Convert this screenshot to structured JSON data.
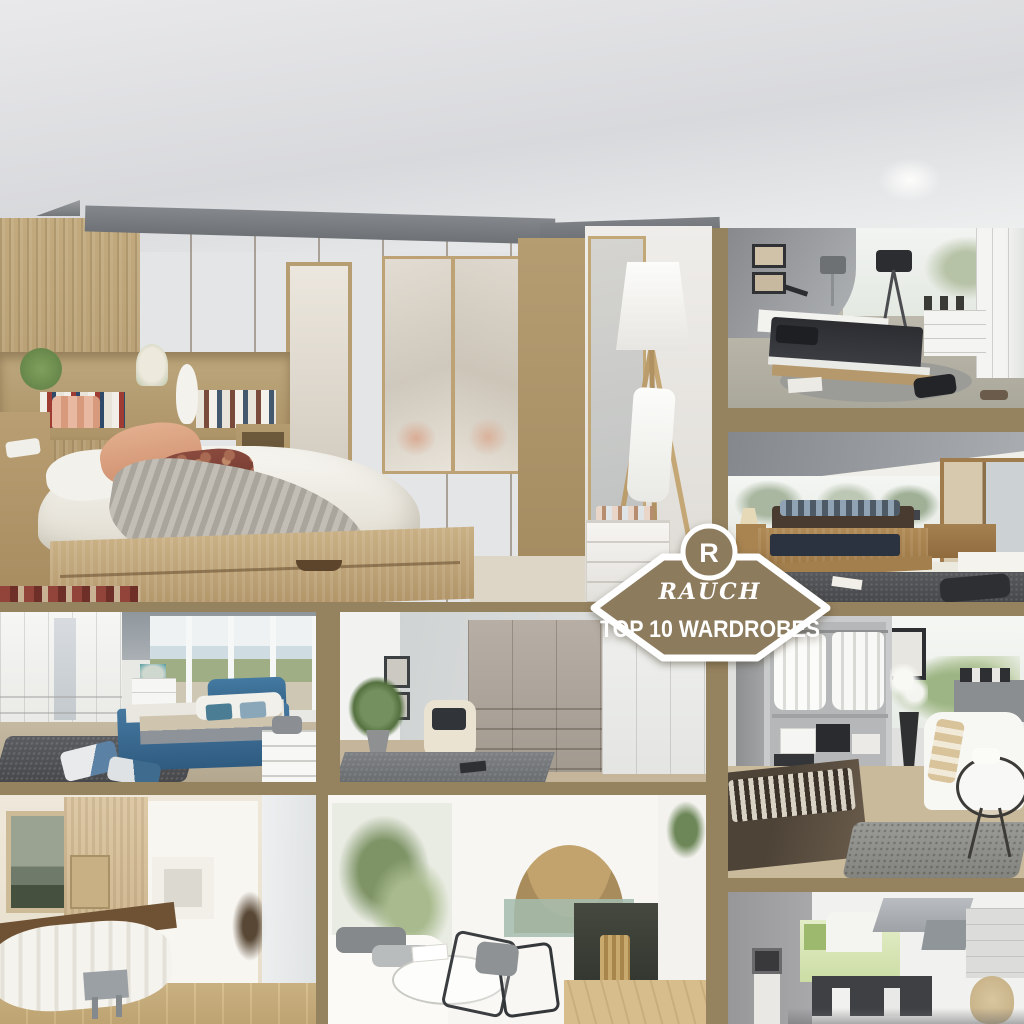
{
  "badge": {
    "monogram": "R",
    "brand_script": "RAUCH",
    "headline": "TOP 10 WARDROBES",
    "fill_color": "#8d7b5d",
    "border_color": "#ffffff",
    "text_color": "#ffffff"
  },
  "collage": {
    "frame_color": "#95825f",
    "tiles": [
      {
        "id": "main-oak-bedroom",
        "position": "top",
        "description": "Light oak fitted bedroom with overbed wardrobes, mirrored doors, double bed with peach pillows, grey knit throw and white tripod floor lamp"
      },
      {
        "id": "modern-grey-bedroom",
        "position": "right-1",
        "description": "Modern bedroom with curved grey wall, framed prints, dark bedding, black tripod lamp, white sideboard and wardrobe"
      },
      {
        "id": "solid-wood-bedroom",
        "position": "right-2",
        "description": "Attic bedroom with panoramic tree view, solid wood bed, dark rug and sliding-door wardrobe"
      },
      {
        "id": "walk-in-closet",
        "position": "right-3",
        "description": "Open wardrobe with hanging white shirts and storage boxes, white armchair, round glass table and striped bench"
      },
      {
        "id": "sketch-kitchen",
        "position": "right-4",
        "description": "Sketched interior with pale green kitchen unit, dark table and grey ceiling ducts"
      },
      {
        "id": "blue-boxspring-bedroom",
        "position": "middle-left",
        "description": "White fitted wardrobes, blue boxspring bed, dark shaggy rug and lake view window"
      },
      {
        "id": "taupe-wardrobe-room",
        "position": "middle-center",
        "description": "Taupe and white wardrobe combination with cream armchair and potted plant"
      },
      {
        "id": "sketch-bedroom",
        "position": "bottom-left",
        "description": "Sketched bedroom with landscape painting, wood panelling and low bed"
      },
      {
        "id": "sketch-living-room",
        "position": "bottom-center",
        "description": "Sketched living room with plants, stone arch fireplace, clear chairs and log basket"
      }
    ]
  }
}
